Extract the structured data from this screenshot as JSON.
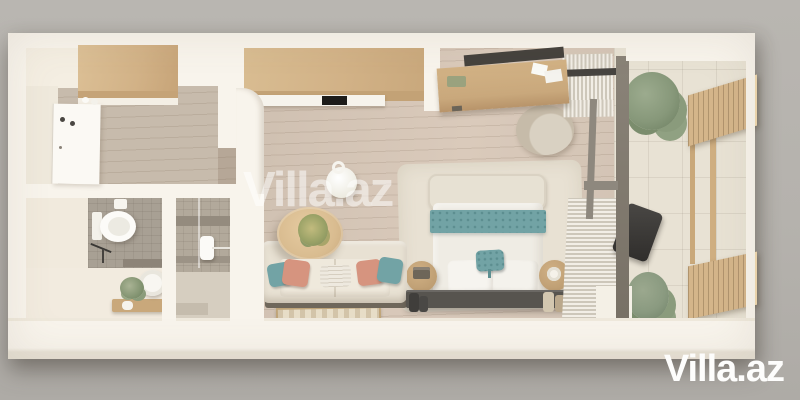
{
  "watermark": {
    "label": "Villa.az"
  },
  "brand": {
    "label": "Villa.az"
  },
  "palette": {
    "bg": "#b5b2ad",
    "wall": "#f8f4ec",
    "wall-shade": "#efe9dc",
    "floor": "#d3c4b5",
    "floor-entry": "#c7bbac",
    "wood": "#d4b58a",
    "wood-dark": "#c09c70",
    "wood-light": "#e9d2aa",
    "teal": "#72a3a5",
    "teal-dark": "#5c8e90",
    "salmon": "#d6947f",
    "sofa": "#e8e1d3",
    "sofa-seat": "#efe9dc",
    "duvet": "#efece4",
    "rug": "#e8e1d3",
    "rug-small": "#e7ddc7",
    "tile": "#e8e2d4",
    "shower-tile": "#b2a99b",
    "bath-tile": "#a8a094",
    "bench": "#57544f",
    "frame": "#837c71",
    "rod": "#474440",
    "plant": "#87987a",
    "plant-dark": "#6e8062",
    "white": "#f9f7f2"
  }
}
